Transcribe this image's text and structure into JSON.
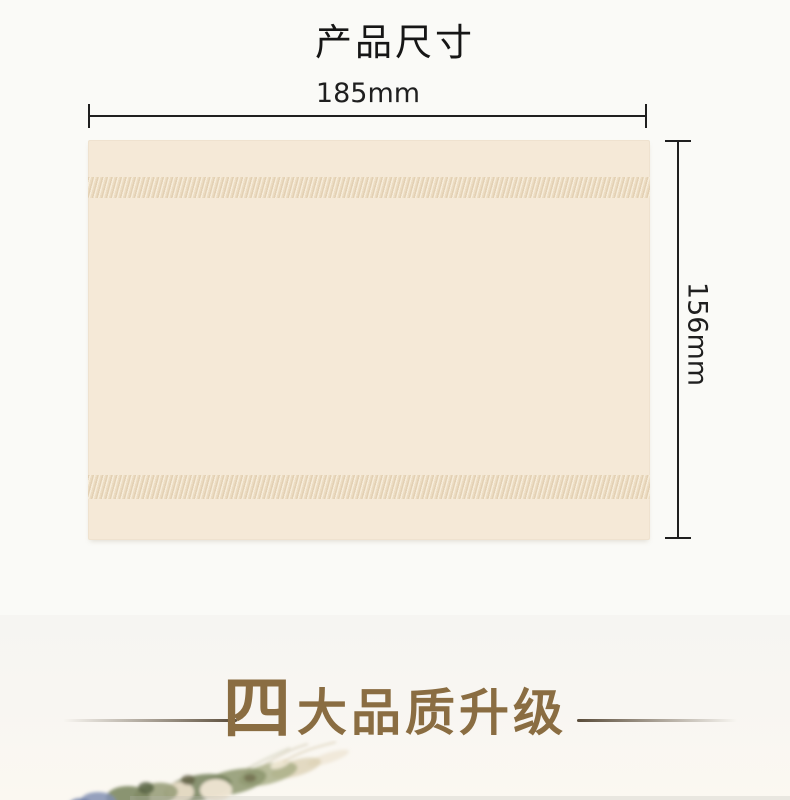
{
  "size_section": {
    "title": "产品尺寸",
    "width_label": "185mm",
    "height_label": "156mm"
  },
  "quality_section": {
    "highlight_char": "四",
    "title_rest": "大品质升级"
  },
  "colors": {
    "background_top": "#fafaf7",
    "background_section2": "#f6f5f2",
    "tissue": "#f5e9d7",
    "tissue_band": "#efe1c9",
    "dimension_line": "#1f1f1f",
    "accent_gold": "#8a6d42",
    "divider_brown": "#5a4c3a"
  }
}
